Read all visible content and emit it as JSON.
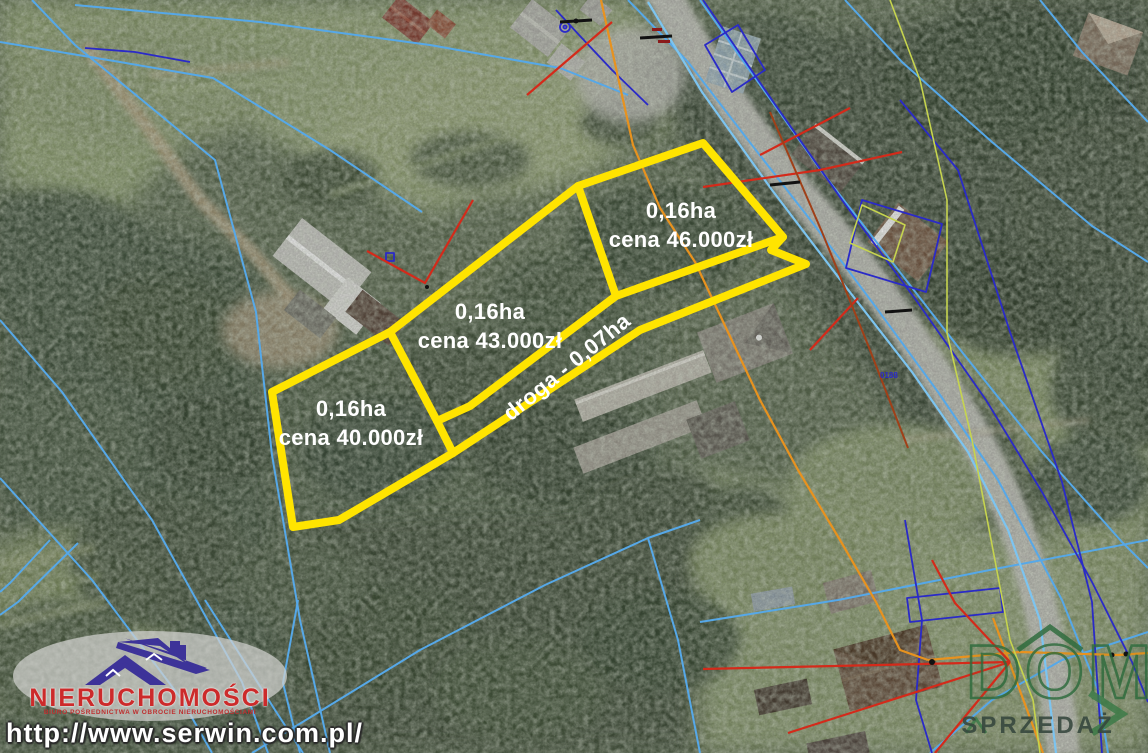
{
  "map": {
    "parcels": [
      {
        "area": "0,16ha",
        "price": "cena 46.000zł"
      },
      {
        "area": "0,16ha",
        "price": "cena 43.000zł"
      },
      {
        "area": "0,16ha",
        "price": "cena 40.000zł"
      }
    ],
    "road_label": "droga - 0,07ha",
    "survey_marker": "0188"
  },
  "watermarks": {
    "agency": {
      "name": "NIERUCHOMOŚCI",
      "tagline": "BIURO POŚREDNICTWA W OBROCIE NIERUCHOMOŚCIAMI",
      "url": "http://www.serwin.com.pl/"
    },
    "listing": {
      "brand": "DOM",
      "label": "SPRZEDAŻ"
    }
  },
  "colors": {
    "parcel_outline": "#ffe400",
    "cadastral_blue": "#56a8e8",
    "cadastral_navy": "#2a2ac8",
    "survey_red": "#d42a1a",
    "survey_orange": "#e8921e",
    "agency_red": "#cc2b2b",
    "agency_navy": "#3d3399",
    "listing_green": "#2d6b3c"
  }
}
